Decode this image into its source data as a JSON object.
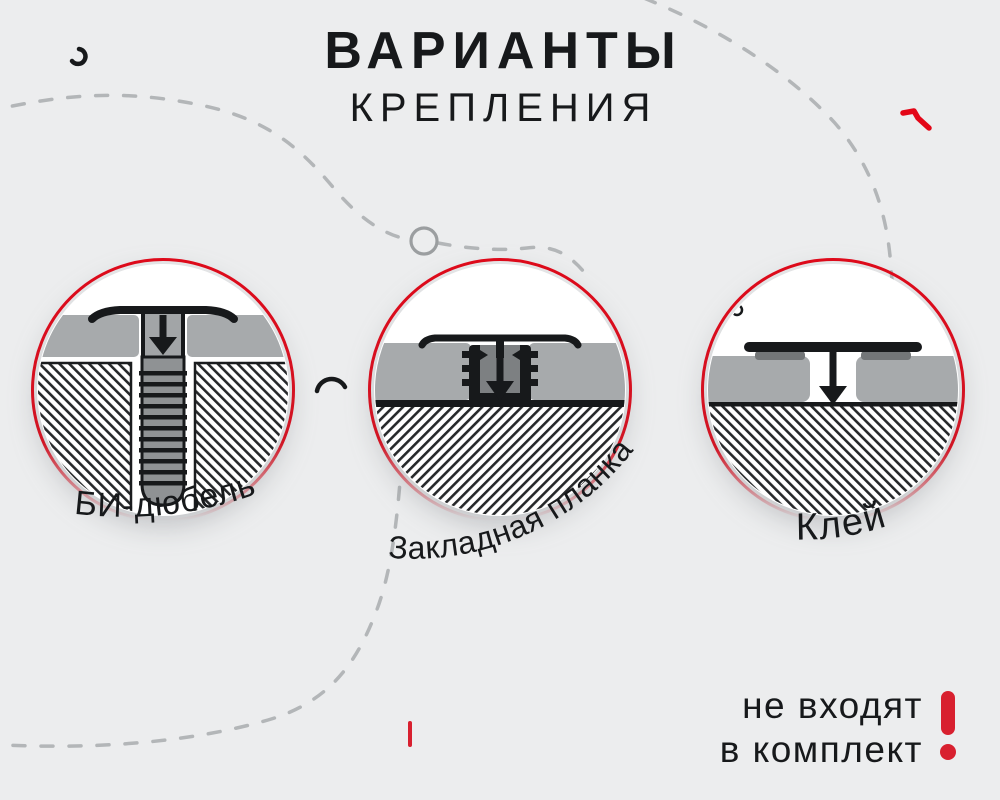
{
  "title": {
    "line1": "ВАРИАНТЫ",
    "line2": "КРЕПЛЕНИЯ"
  },
  "options": [
    {
      "label": "БИ-дюбель"
    },
    {
      "label": "Закладная планка"
    },
    {
      "label": "Клей"
    }
  ],
  "note": {
    "line1": "не входят",
    "line2": "в комплект",
    "mark": "!"
  },
  "colors": {
    "background": "#ecedee",
    "ink": "#17191b",
    "accent_red": "#e30617",
    "warning_red": "#d8202f",
    "panel_gray": "#a7aaac",
    "channel_gray": "#7d8082",
    "dash_gray": "#b3b6b8"
  }
}
